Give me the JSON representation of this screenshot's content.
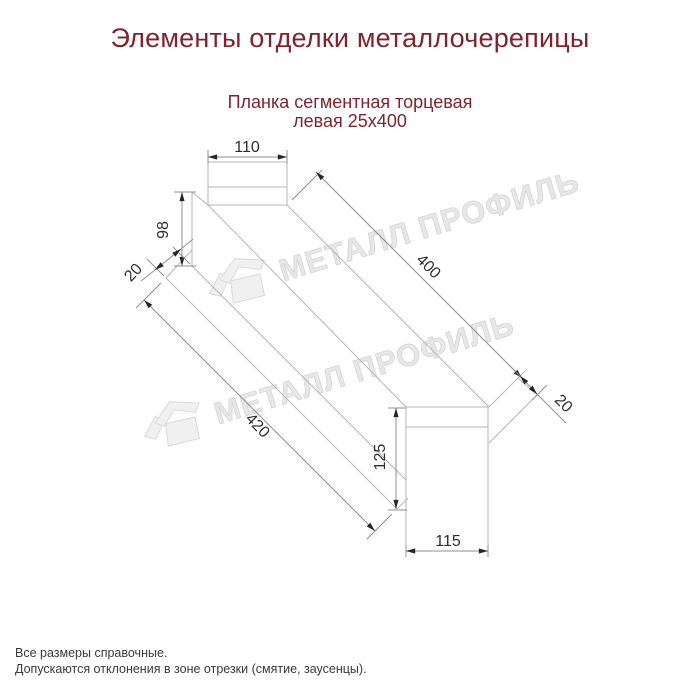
{
  "header": {
    "title": "Элементы отделки металлочерепицы",
    "title_color": "#7d2430"
  },
  "product": {
    "name_line1": "Планка сегментная торцевая",
    "name_line2": "левая 25х400"
  },
  "drawing": {
    "type": "dimensioned technical drawing, axonometric view of left segmental end strip",
    "dimensions": {
      "top_width": "110",
      "left_height": "98",
      "left_hem": "20",
      "length_top": "400",
      "length_bottom": "420",
      "right_hem": "20",
      "right_height": "125",
      "bottom_width": "115"
    },
    "shape_line_color": "#b6b6b6",
    "dimension_line_color": "#8f8f8f",
    "arrow_color": "#262626",
    "dimension_text_color": "#2e2e2e"
  },
  "watermark": {
    "text": "МЕТАЛЛ ПРОФИЛЬ",
    "color": "#e7e7e7"
  },
  "notes": {
    "line1": "Все размеры справочные.",
    "line2": "Допускаются отклонения в зоне отрезки (смятие, заусенцы)."
  }
}
